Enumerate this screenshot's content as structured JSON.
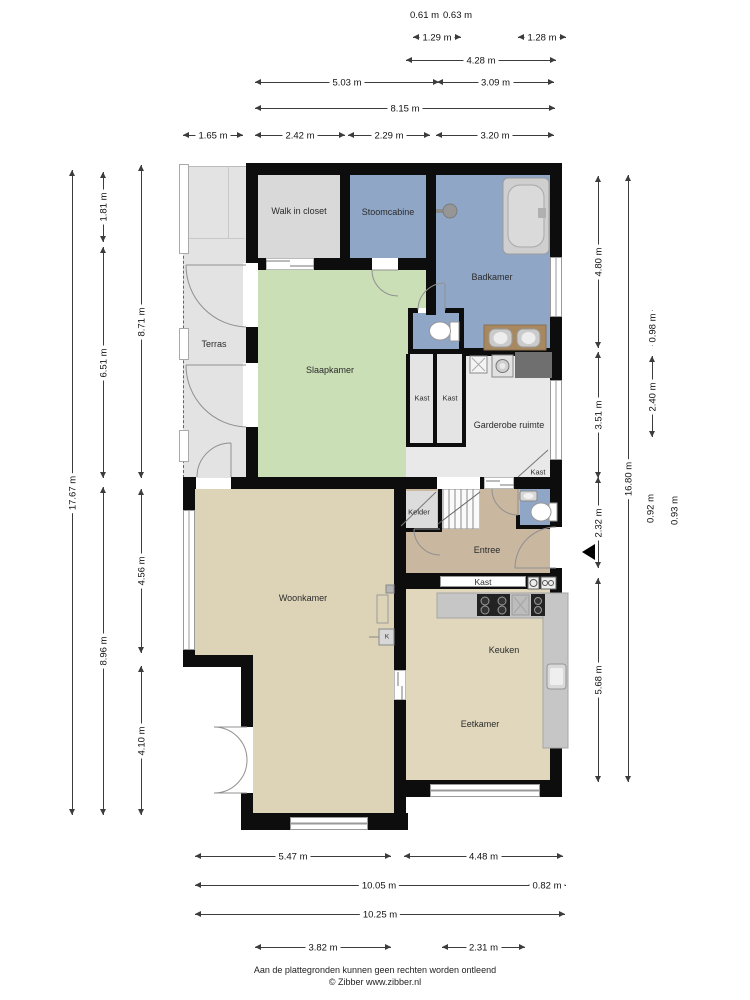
{
  "page": {
    "footer_line1": "Aan de plattegronden kunnen geen rechten worden ontleend",
    "footer_line2": "© Zibber www.zibber.nl"
  },
  "rooms": {
    "walk_in_closet": "Walk in closet",
    "stoomcabine": "Stoomcabine",
    "badkamer": "Badkamer",
    "terras": "Terras",
    "slaapkamer": "Slaapkamer",
    "kast_a": "Kast",
    "kast_b": "Kast",
    "garderobe": "Garderobe ruimte",
    "kast_c": "Kast",
    "kelder": "Kelder",
    "entree": "Entree",
    "kast_d": "Kast",
    "woonkamer": "Woonkamer",
    "keuken": "Keuken",
    "eetkamer": "Eetkamer",
    "kast_k": "K"
  },
  "dimensions": {
    "top": [
      "0.61 m",
      "0.63 m",
      "1.29 m",
      "1.28 m",
      "4.28 m",
      "5.03 m",
      "3.09 m",
      "8.15 m",
      "1.65 m",
      "2.42 m",
      "2.29 m",
      "3.20 m"
    ],
    "left": [
      "1.81 m",
      "8.71 m",
      "6.51 m",
      "17.67 m",
      "4.56 m",
      "8.96 m",
      "4.10 m"
    ],
    "right": [
      "4.80 m",
      "0.98 m",
      "2.40 m",
      "3.51 m",
      "16.80 m",
      "0.92 m",
      "0.93 m",
      "2.32 m",
      "5.68 m"
    ],
    "bottom": [
      "5.47 m",
      "4.48 m",
      "10.05 m",
      "0.82 m",
      "10.25 m",
      "3.82 m",
      "2.31 m"
    ]
  },
  "colors": {
    "wall": "#0d0d0d",
    "terras": "#e3e3e3",
    "closet": "#d9d9d9",
    "bath_blue": "#8fa6c6",
    "bedroom_green": "#cadfb5",
    "living_beige": "#ddd4b8",
    "kitchen_beige": "#e0d7bc",
    "entree_tan": "#c9b7a0",
    "garderobe_gray": "#e9e9e9",
    "kastroom_gray": "#e4e4e4",
    "counter_gray": "#c6c6c6",
    "dark_counter": "#6f6f6f",
    "vanity_brown": "#a8895f"
  }
}
